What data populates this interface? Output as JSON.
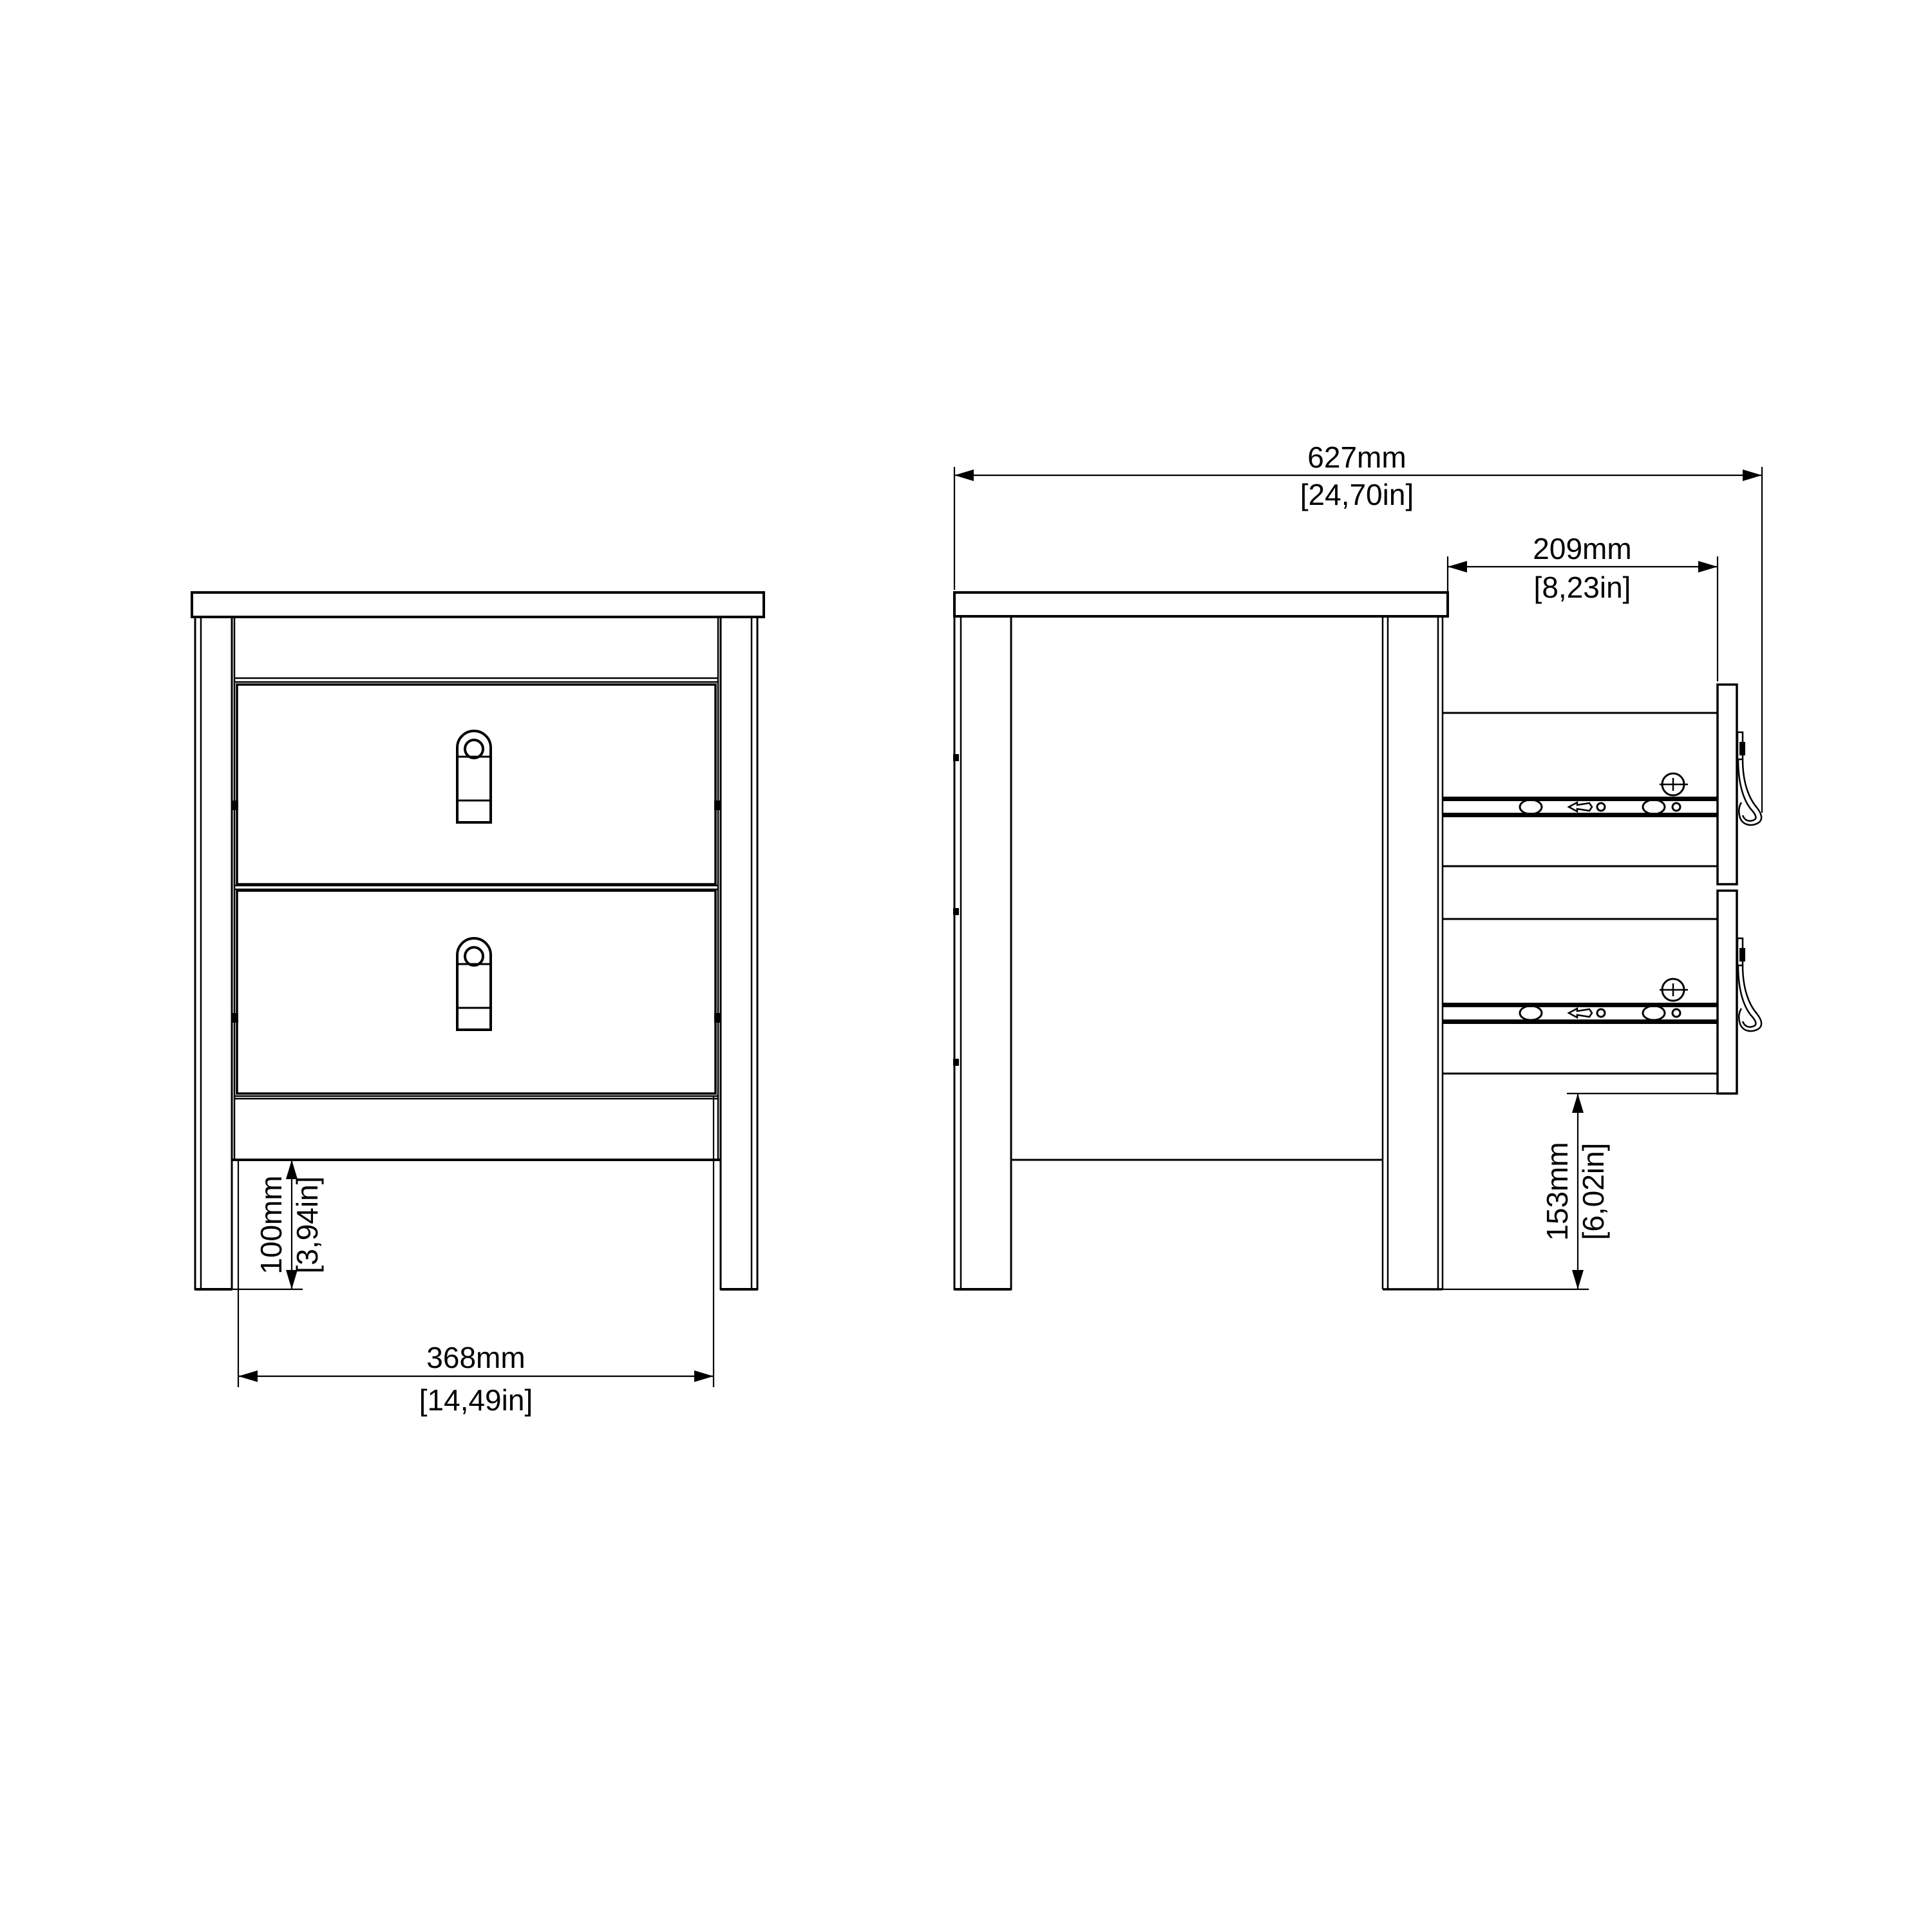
{
  "drawing": {
    "type": "furniture technical drawing, bedside table front and side views",
    "colors": {
      "line": "#000000",
      "background": "#ffffff"
    },
    "dimensions": {
      "overall_depth": {
        "mm": "627mm",
        "inches": "[24,70in]"
      },
      "drawer_extension": {
        "mm": "209mm",
        "inches": "[8,23in]"
      },
      "drawer_front_width": {
        "mm": "368mm",
        "inches": "[14,49in]"
      },
      "plinth_height": {
        "mm": "100mm",
        "inches": "[3,94in]"
      },
      "drawer_floor_clearance": {
        "mm": "153mm",
        "inches": "[6,02in]"
      }
    }
  }
}
